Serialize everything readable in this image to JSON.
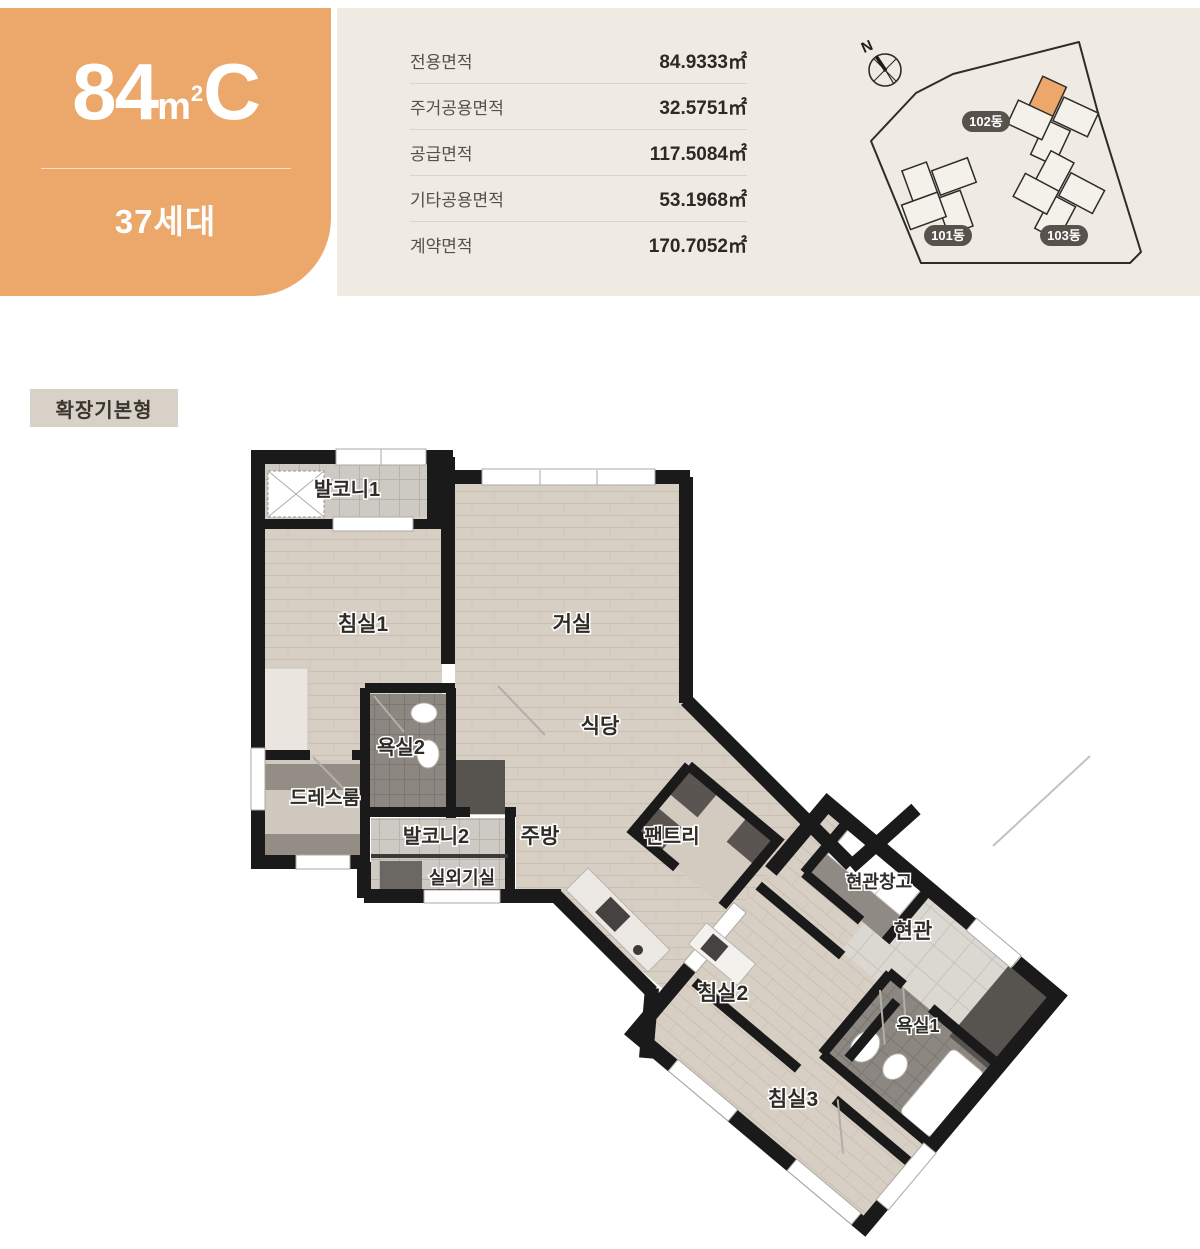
{
  "unit_card": {
    "size": "84",
    "unit_base": "m",
    "unit_exp": "2",
    "type": "C",
    "households": "37세대",
    "accent_color": "#ECA76B"
  },
  "area_table": {
    "rows": [
      {
        "label": "전용면적",
        "value": "84.9333㎡"
      },
      {
        "label": "주거공용면적",
        "value": "32.5751㎡"
      },
      {
        "label": "공급면적",
        "value": "117.5084㎡"
      },
      {
        "label": "기타공용면적",
        "value": "53.1968㎡"
      },
      {
        "label": "계약면적",
        "value": "170.7052㎡"
      }
    ]
  },
  "site_plan": {
    "compass_label": "N",
    "buildings": [
      {
        "label": "102동",
        "highlighted": true
      },
      {
        "label": "101동",
        "highlighted": false
      },
      {
        "label": "103동",
        "highlighted": false
      }
    ],
    "pill_color": "#57524B",
    "highlight_color": "#ECA76B"
  },
  "plan": {
    "badge": "확장기본형",
    "wall_color": "#1A1A1A",
    "floor_color": "#D8CFC4",
    "rooms": [
      {
        "id": "balcony1",
        "label": "발코니1"
      },
      {
        "id": "bedroom1",
        "label": "침실1"
      },
      {
        "id": "living",
        "label": "거실"
      },
      {
        "id": "dining",
        "label": "식당"
      },
      {
        "id": "bathroom2",
        "label": "욕실2"
      },
      {
        "id": "dressroom",
        "label": "드레스룸"
      },
      {
        "id": "balcony2",
        "label": "발코니2"
      },
      {
        "id": "kitchen",
        "label": "주방"
      },
      {
        "id": "pantry",
        "label": "팬트리"
      },
      {
        "id": "utility",
        "label": "실외기실"
      },
      {
        "id": "entry-storage",
        "label": "현관창고"
      },
      {
        "id": "entry",
        "label": "현관"
      },
      {
        "id": "bedroom2",
        "label": "침실2"
      },
      {
        "id": "bathroom1",
        "label": "욕실1"
      },
      {
        "id": "bedroom3",
        "label": "침실3"
      }
    ]
  }
}
